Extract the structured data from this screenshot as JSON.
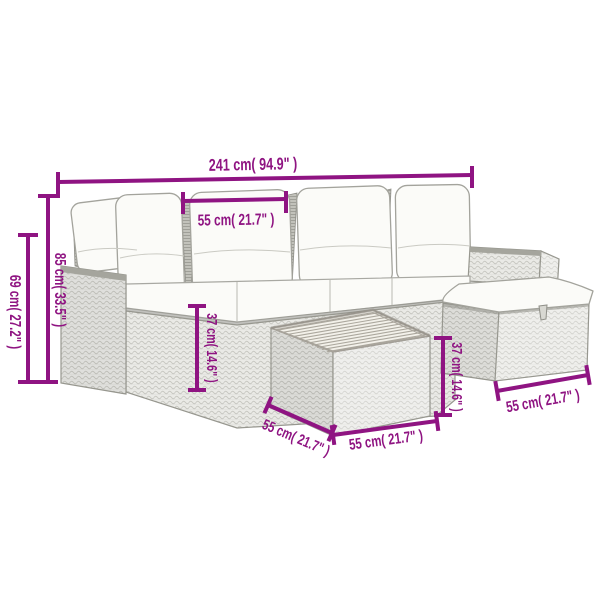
{
  "image": {
    "kind": "product-dimension-diagram",
    "subject": "rattan garden lounge set with cushions, ottoman and coffee table"
  },
  "colors": {
    "dimension_accent": "#8F1482",
    "background": "#FFFFFF",
    "rattan_light": "#EAEAE6",
    "cushion_white": "#FBFBF8"
  },
  "dims": {
    "total_width": "241 cm( 94.9\" )",
    "section_width": "55 cm( 21.7\" )",
    "back_height": "85 cm( 33.5\" )",
    "arm_height": "69 cm( 27.2\" )",
    "seat_height": "37 cm( 14.6\" )",
    "ottoman_height": "37 cm( 14.6\" )",
    "table_depth": "55 cm( 21.7\" )",
    "table_width": "55 cm( 21.7\" )",
    "ottoman_width": "55 cm( 21.7\" )"
  }
}
